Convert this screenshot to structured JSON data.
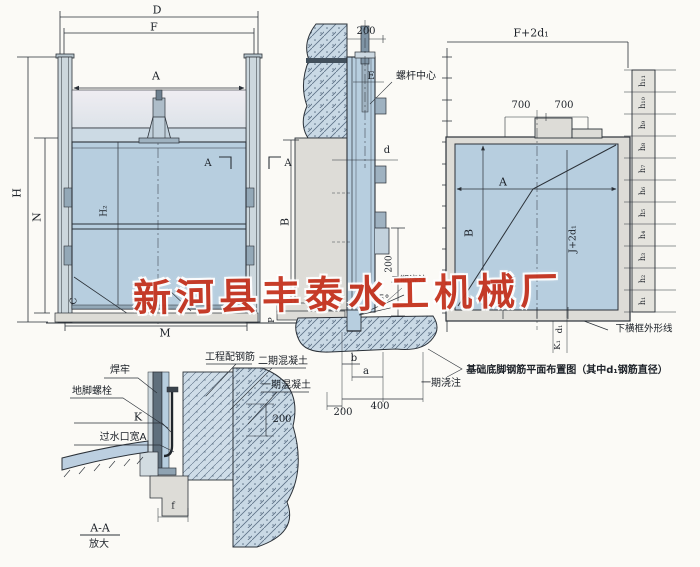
{
  "watermark": {
    "text": "新河县丰泰水工机械厂",
    "color": "#c5331f"
  },
  "front_view": {
    "dim_D": "D",
    "dim_F": "F",
    "dim_A": "A",
    "dim_H": "H",
    "dim_N": "N",
    "dim_H2": "H₂",
    "dim_C": "C",
    "dim_M": "M",
    "dim_P": "P",
    "section_mark_left": "A",
    "section_mark_right": "A"
  },
  "side_view": {
    "dim_200_top": "200",
    "screw_center_label": "螺杆中心",
    "dim_E": "E",
    "dim_d": "d",
    "dim_B": "B",
    "dim_200_vertical": "200",
    "stage2_pour_label": "二期浇注",
    "angle_label": "25°",
    "dim_b": "b",
    "dim_a": "a",
    "dim_200_bottom": "200",
    "dim_400": "400",
    "stage1_pour_label": "一期浇注"
  },
  "plan_view": {
    "dim_F_2d1": "F+2d₁",
    "dim_700_left": "700",
    "dim_700_right": "700",
    "dim_A": "A",
    "dim_B": "B",
    "dim_J_2d1": "J+2d₁",
    "dim_d1": "d₁",
    "dim_K1": "K₁",
    "bottom_frame_label": "下横框外形线",
    "caption": "基础底脚钢筋平面布置图（其中d₁钢筋直径）",
    "h_labels": [
      "h₁",
      "h₂",
      "h₃",
      "h₄",
      "h₅",
      "h₆",
      "h₇",
      "h₈",
      "h₉",
      "h₁₀",
      "h₁₁"
    ]
  },
  "detail_view": {
    "weld_label": "焊牢",
    "anchor_bolt_label": "地脚螺栓",
    "dim_K": "K",
    "water_opening_label": "过水口宽A",
    "rebar_label": "工程配钢筋",
    "stage2_concrete_label": "二期混凝土",
    "stage1_concrete_label": "一期混凝土",
    "dim_200": "200",
    "dim_f": "f",
    "section_title": "A-A",
    "section_subtitle": "放大"
  }
}
